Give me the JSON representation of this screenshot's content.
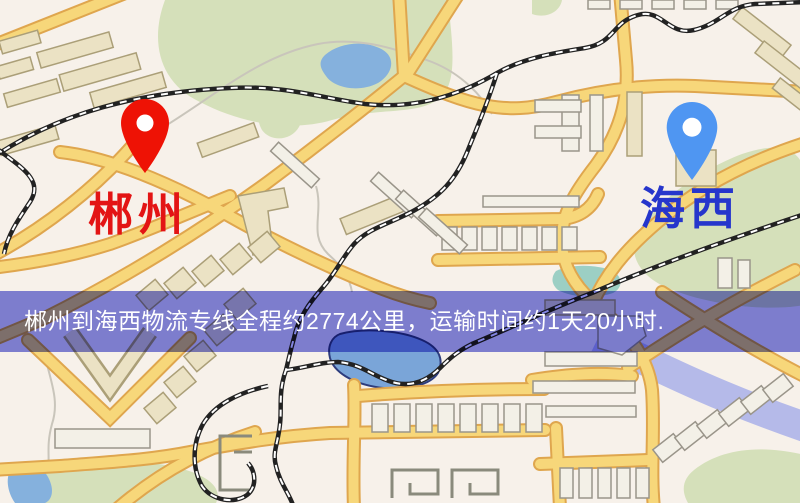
{
  "origin": {
    "label": "郴州",
    "pin_icon": "red-map-pin-icon",
    "pin_color": "#ee1205",
    "label_color": "#e31414"
  },
  "destination": {
    "label": "海西",
    "pin_icon": "blue-map-pin-icon",
    "pin_color": "#4f96f2",
    "label_color": "#2636cc"
  },
  "banner": {
    "text": "郴州到海西物流专线全程约2774公里，运输时间约1天20小时.",
    "text_color": "#ffffff",
    "bg_color": "#8184e0"
  },
  "map_palette": {
    "background": "#f7f1ea",
    "road_fill": "#f7d77a",
    "road_casing": "#dfa64e",
    "park_green": "#d5e0ba",
    "water_blue": "#85b1dd",
    "railway_black": "#222222",
    "building_tan": "#ebe2c4",
    "building_light": "#f3f0e7",
    "river_band": "#98a2e8"
  }
}
